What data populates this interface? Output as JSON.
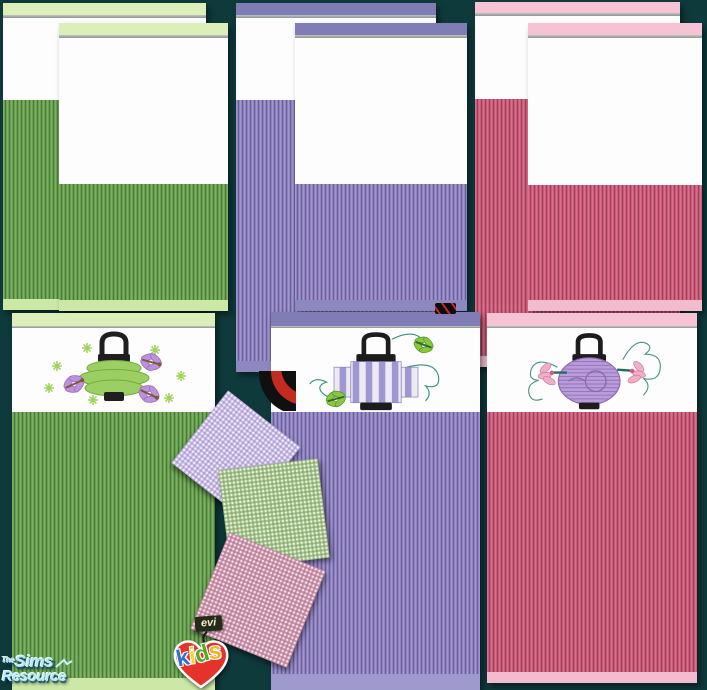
{
  "background_color": "#0f3a3c",
  "bedding_sets": {
    "green": {
      "label": "green striped bedding",
      "band_color": "#ddefb8",
      "stripe_color": "#6aa351",
      "stripe_dark": "#3f6f2f",
      "footer_color": "#cde8a6"
    },
    "purple": {
      "label": "purple striped bedding",
      "band_color": "#7f7cb6",
      "stripe_color": "#9186c2",
      "stripe_dark": "#5e5390",
      "footer_color": "#8d89c0"
    },
    "pink": {
      "label": "pink striped bedding",
      "band_color": "#f5c3d4",
      "stripe_color": "#d05f7c",
      "stripe_dark": "#8e3553",
      "footer_color": "#f2bcce"
    }
  },
  "lantern_panels": [
    {
      "art": "green-tiered-paper-lantern",
      "accents": [
        "purple-dragonflies",
        "green-sparkles"
      ],
      "lantern_color": "#9ccf63"
    },
    {
      "art": "purple-striped-box-lantern",
      "accents": [
        "green-dragonflies",
        "teal-swirls"
      ],
      "lantern_color": "#9f97d2"
    },
    {
      "art": "purple-round-paper-lantern",
      "accents": [
        "pink-flowers",
        "teal-swirls"
      ],
      "lantern_color": "#bb9cda"
    }
  ],
  "swatches": [
    {
      "name": "lavender-dotted-swatch",
      "color": "#c9b9e8"
    },
    {
      "name": "green-dotted-swatch",
      "color": "#a3c487"
    },
    {
      "name": "pink-dotted-swatch",
      "color": "#cf93ab"
    }
  ],
  "logos": {
    "tsr": {
      "the": "The",
      "sims": "Sims",
      "resource": "Resource",
      "text_color": "#b9e6f4"
    },
    "evikids": {
      "tag": "evi",
      "letters": [
        {
          "char": "k",
          "color": "#2f6fd0"
        },
        {
          "char": "i",
          "color": "#f7d733"
        },
        {
          "char": "d",
          "color": "#56a825"
        },
        {
          "char": "s",
          "color": "#f0b41f"
        }
      ],
      "heart_color": "#e5322a"
    }
  }
}
